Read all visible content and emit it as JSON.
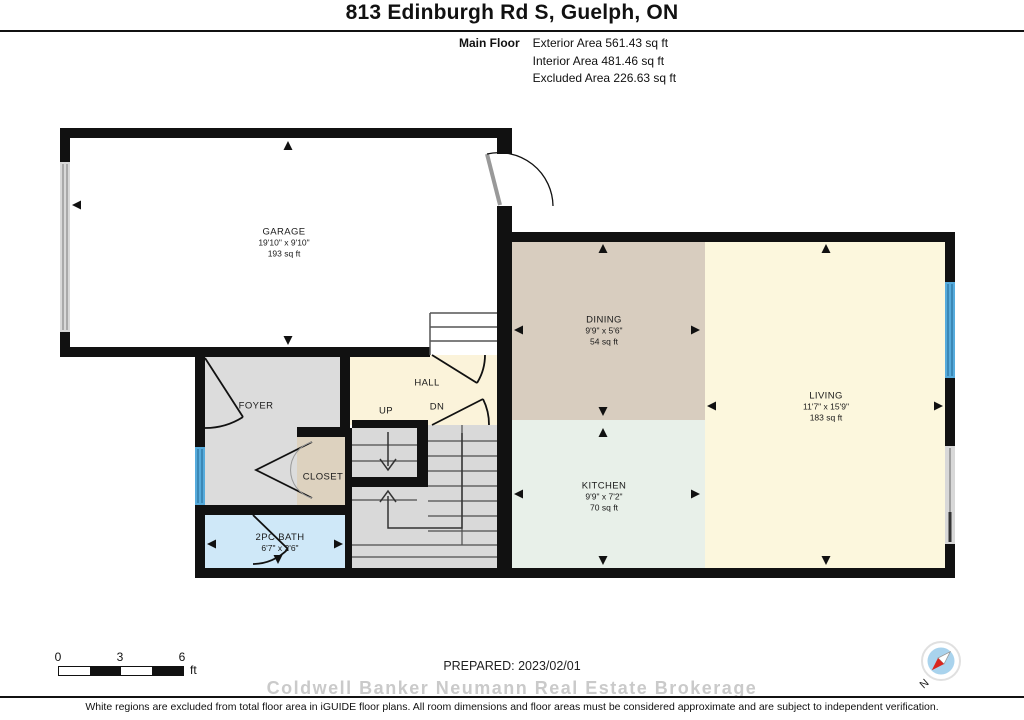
{
  "header": {
    "title": "813 Edinburgh Rd S, Guelph, ON",
    "floor_label": "Main Floor",
    "area_lines": [
      "Exterior Area 561.43 sq ft",
      "Interior Area 481.46 sq ft",
      "Excluded Area 226.63 sq ft"
    ]
  },
  "rooms": {
    "garage": {
      "name": "GARAGE",
      "dims": "19'10\" x 9'10\"",
      "area": "193 sq ft"
    },
    "dining": {
      "name": "DINING",
      "dims": "9'9\" x 5'6\"",
      "area": "54 sq ft"
    },
    "living": {
      "name": "LIVING",
      "dims": "11'7\" x 15'9\"",
      "area": "183 sq ft"
    },
    "kitchen": {
      "name": "KITCHEN",
      "dims": "9'9\" x 7'2\"",
      "area": "70 sq ft"
    },
    "bath": {
      "name": "2PC BATH",
      "dims": "6'7\" x 2'6\""
    },
    "foyer": {
      "name": "FOYER"
    },
    "hall": {
      "name": "HALL"
    },
    "closet": {
      "name": "CLOSET"
    },
    "stairs": {
      "up": "UP",
      "down": "DN"
    }
  },
  "footer": {
    "scale": {
      "ticks": [
        "0",
        "3",
        "6"
      ],
      "unit": "ft"
    },
    "prepared": "PREPARED: 2023/02/01",
    "watermark": "Coldwell Banker Neumann Real Estate Brokerage",
    "disclaimer": "White regions are excluded from total floor area in iGUIDE floor plans. All room dimensions and floor areas must be considered approximate and are subject to independent verification."
  },
  "compass": {
    "north_label": "N"
  },
  "colors": {
    "wall": "#111111",
    "dining": "#d8cdbf",
    "living": "#fcf7dd",
    "hall": "#fbf3da",
    "kitchen": "#e8f0e9",
    "foyer": "#dcdcdc",
    "closet": "#ddd2bf",
    "bath": "#cfe8f8",
    "stairs": "#d9d9d9",
    "window": "#56abdc",
    "door_panel": "#d8d8d8",
    "compass_red": "#d9251d"
  }
}
